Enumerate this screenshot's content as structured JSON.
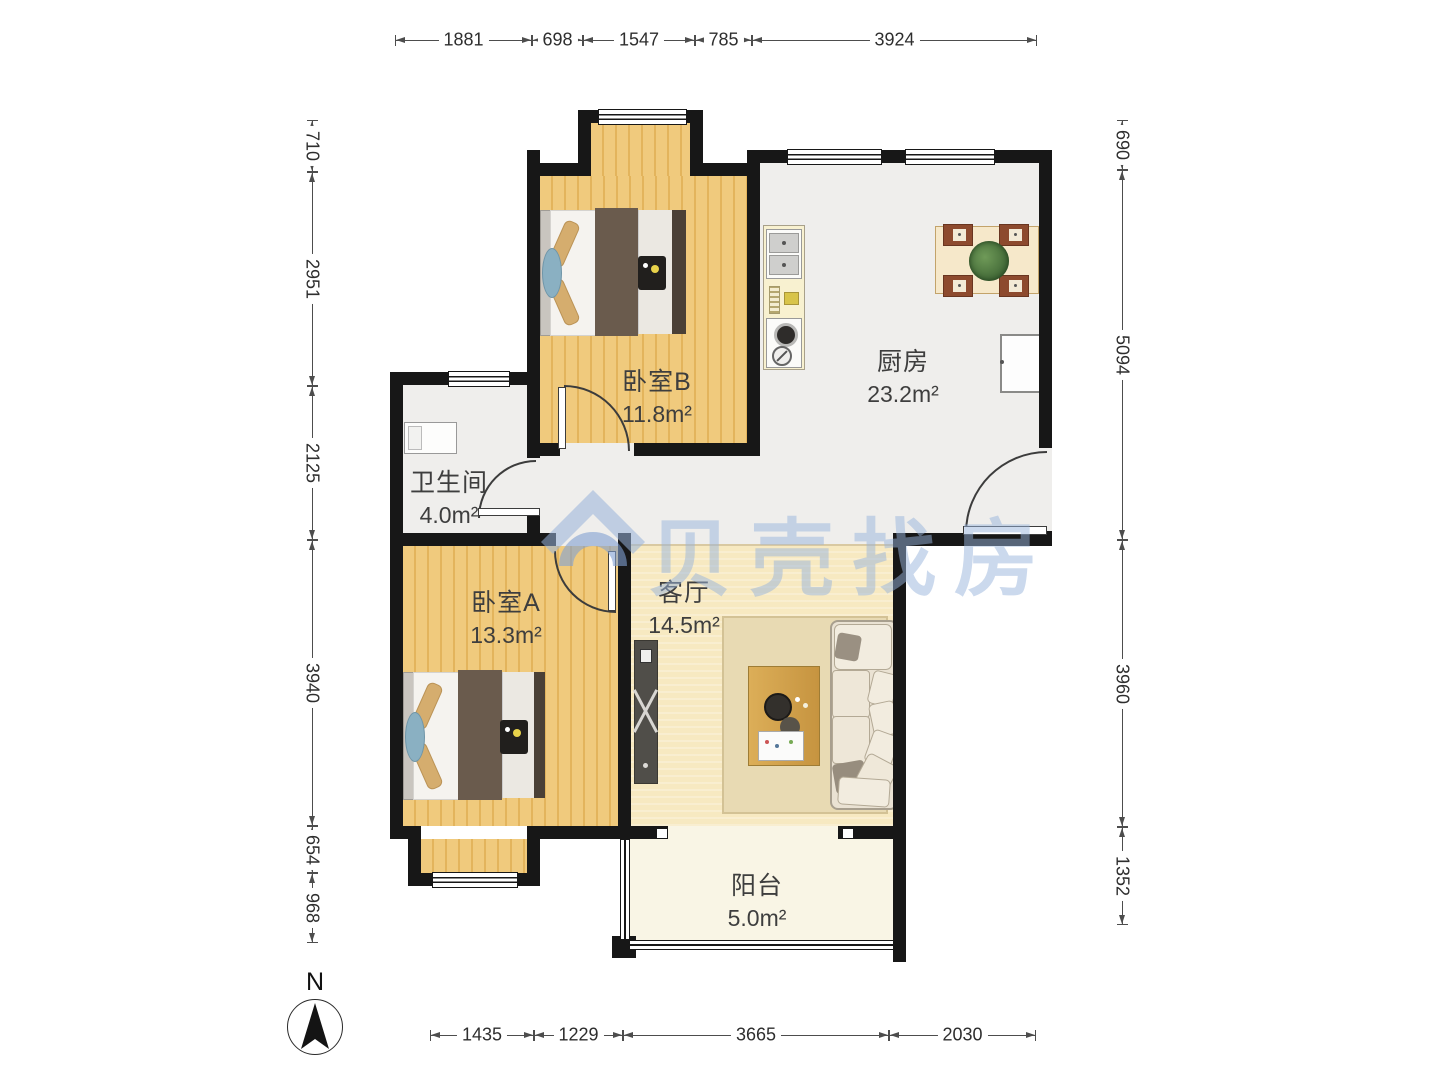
{
  "watermark": {
    "text": "贝壳找房",
    "color": "#98b3db"
  },
  "compass": {
    "label": "N"
  },
  "rooms": [
    {
      "name": "卧室B",
      "area": "11.8m²"
    },
    {
      "name": "厨房",
      "area": "23.2m²"
    },
    {
      "name": "卫生间",
      "area": "4.0m²"
    },
    {
      "name": "卧室A",
      "area": "13.3m²"
    },
    {
      "name": "客厅",
      "area": "14.5m²"
    },
    {
      "name": "阳台",
      "area": "5.0m²"
    }
  ],
  "dimensions": {
    "top": [
      "1881",
      "698",
      "1547",
      "785",
      "3924"
    ],
    "bottom": [
      "1435",
      "1229",
      "3665",
      "2030"
    ],
    "left": [
      "710",
      "2951",
      "2125",
      "3940",
      "654",
      "968"
    ],
    "right": [
      "690",
      "5094",
      "3960",
      "1352"
    ]
  },
  "colors": {
    "wall": "#171717",
    "wood_floor": "#eec778",
    "tile_floor": "#efeeec",
    "living_floor": "#f7e9c1",
    "balcony_floor": "#f9f5e5"
  }
}
